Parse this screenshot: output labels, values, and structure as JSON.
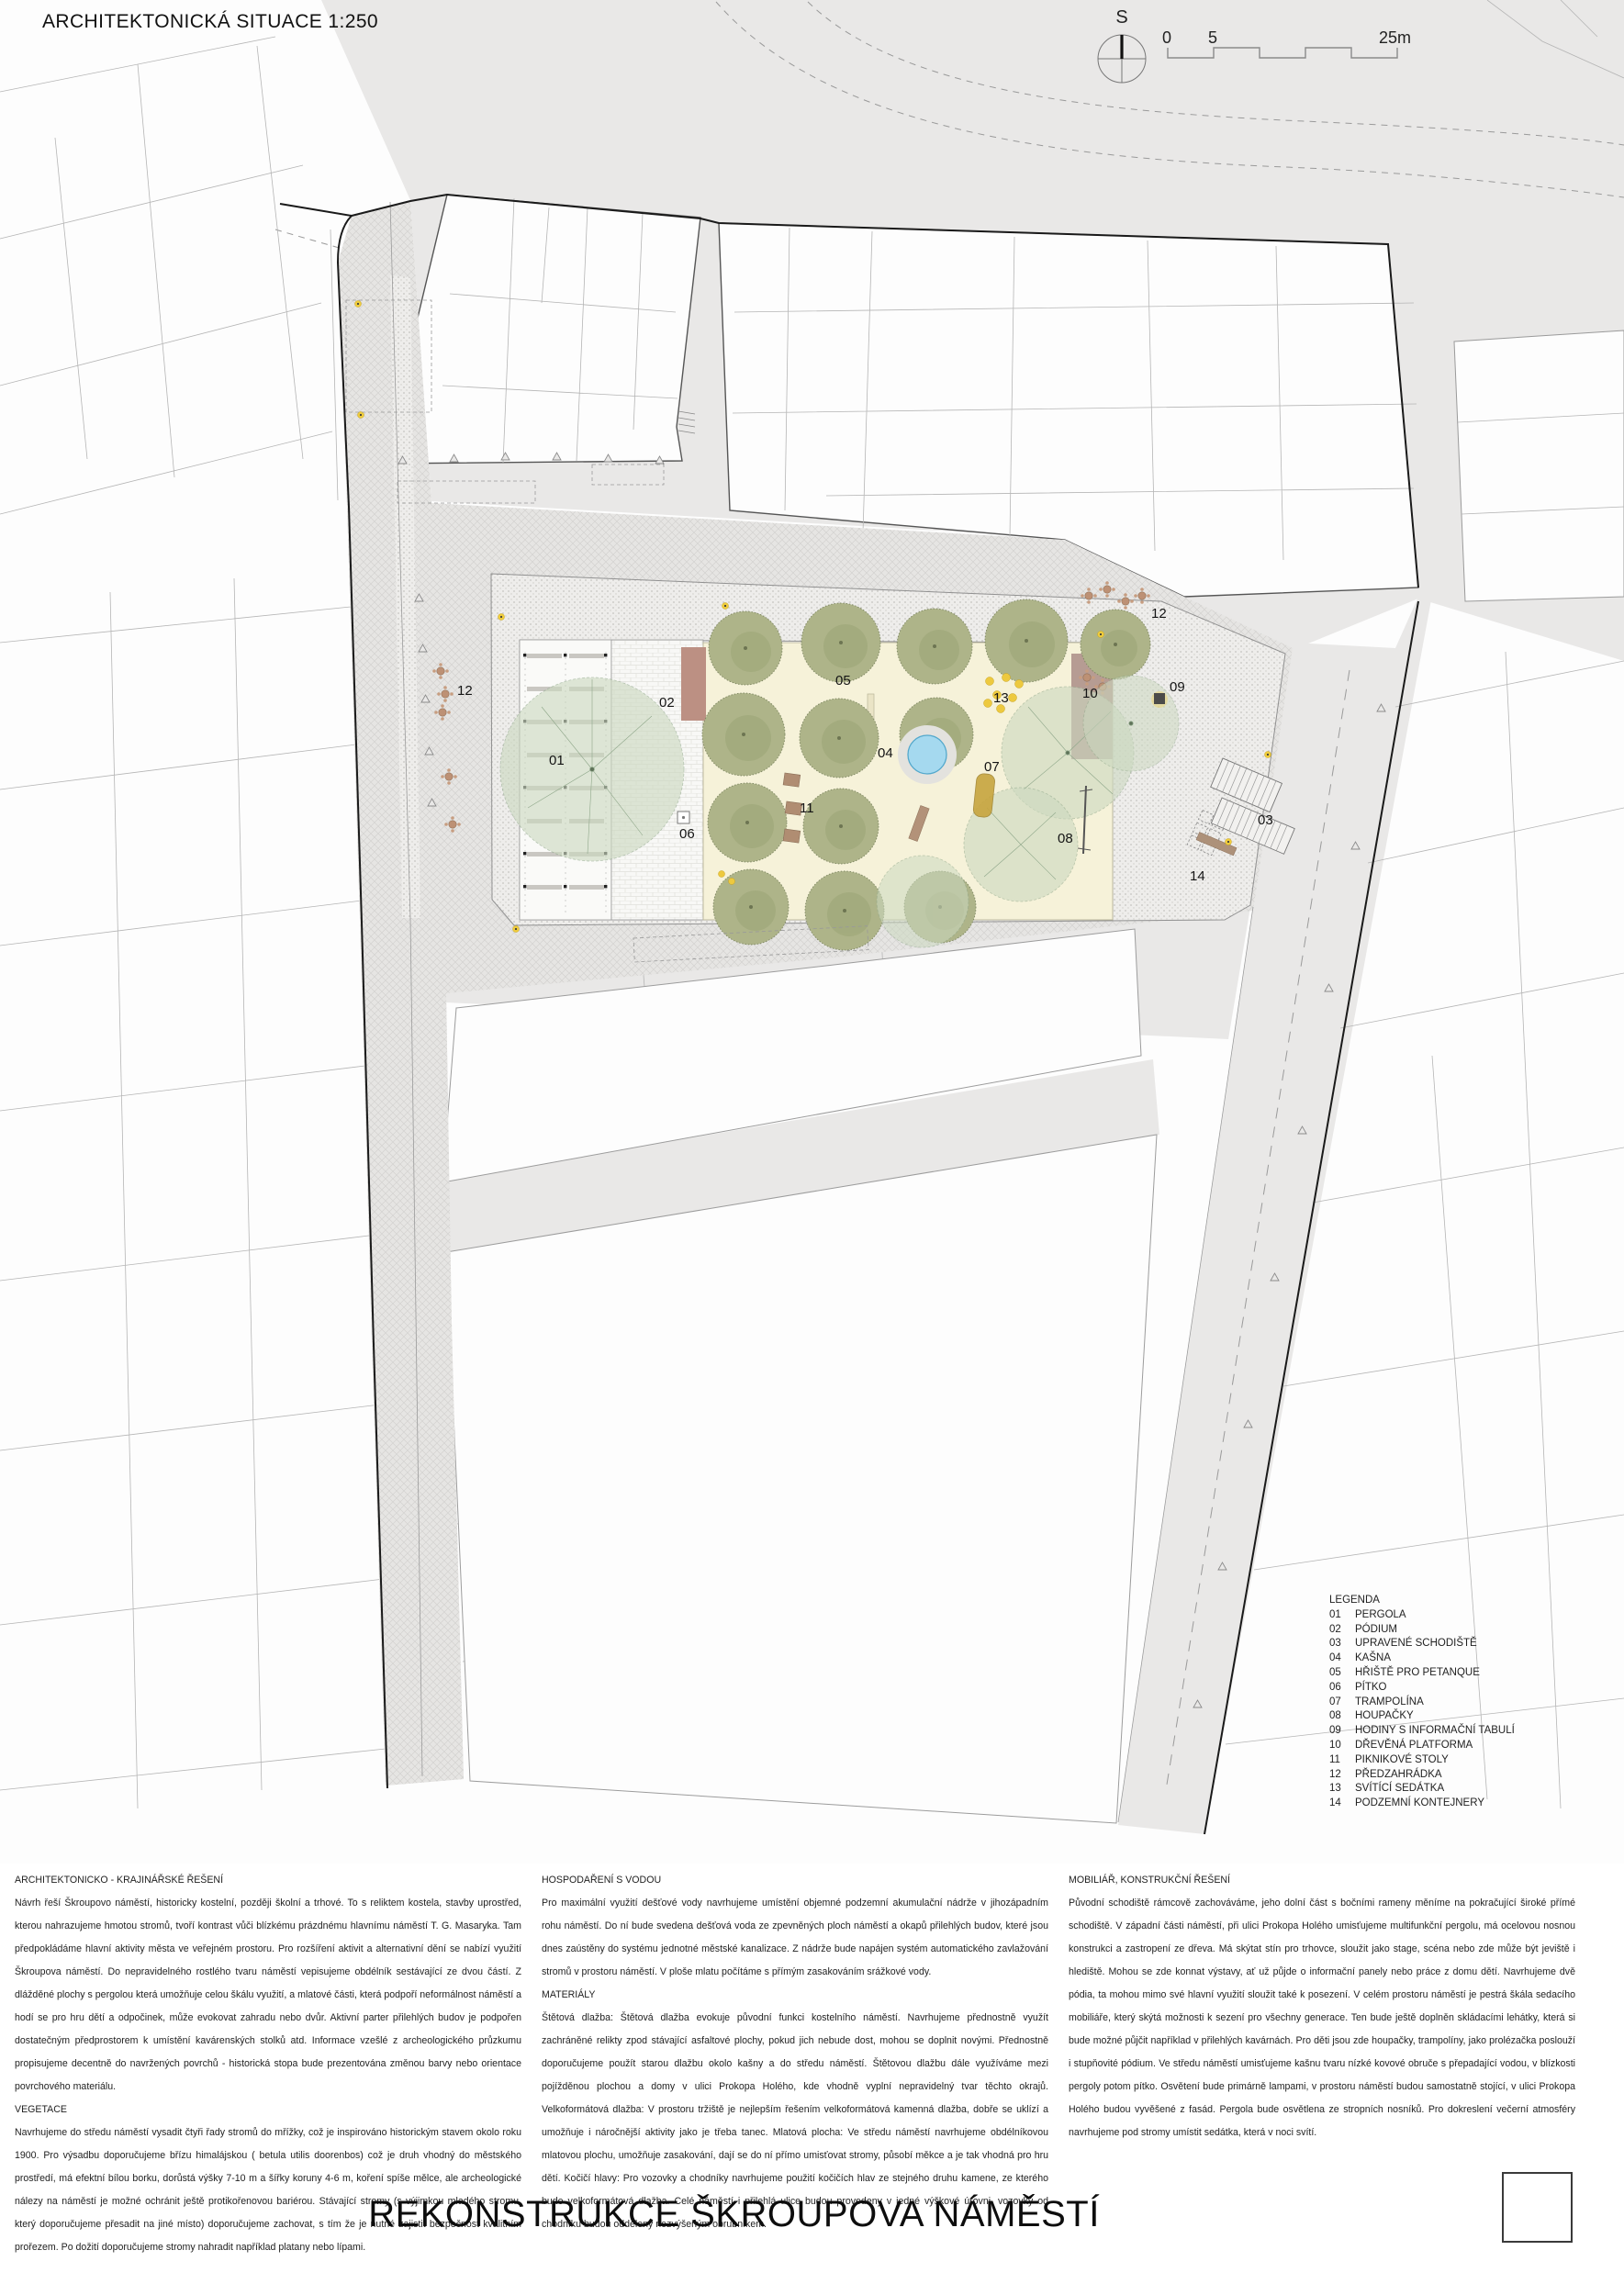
{
  "header": {
    "title": "ARCHITEKTONICKÁ SITUACE 1:250"
  },
  "north": {
    "label": "S"
  },
  "scalebar": {
    "zero": "0",
    "five": "5",
    "max": "25m"
  },
  "legend": {
    "title": "LEGENDA",
    "items": [
      {
        "num": "01",
        "label": "PERGOLA"
      },
      {
        "num": "02",
        "label": "PÓDIUM"
      },
      {
        "num": "03",
        "label": "UPRAVENÉ SCHODIŠTĚ"
      },
      {
        "num": "04",
        "label": "KAŠNA"
      },
      {
        "num": "05",
        "label": "HŘIŠTĚ PRO PETANQUE"
      },
      {
        "num": "06",
        "label": "PÍTKO"
      },
      {
        "num": "07",
        "label": "TRAMPOLÍNA"
      },
      {
        "num": "08",
        "label": "HOUPAČKY"
      },
      {
        "num": "09",
        "label": "HODINY S INFORMAČNÍ TABULÍ"
      },
      {
        "num": "10",
        "label": "DŘEVĚNÁ PLATFORMA"
      },
      {
        "num": "11",
        "label": "PIKNIKOVÉ STOLY"
      },
      {
        "num": "12",
        "label": "PŘEDZAHRÁDKA"
      },
      {
        "num": "13",
        "label": "SVÍTÍCÍ SEDÁTKA"
      },
      {
        "num": "14",
        "label": "PODZEMNÍ KONTEJNERY"
      }
    ]
  },
  "map": {
    "markers": [
      {
        "label": "01"
      },
      {
        "label": "02"
      },
      {
        "label": "03"
      },
      {
        "label": "04"
      },
      {
        "label": "05"
      },
      {
        "label": "06"
      },
      {
        "label": "07"
      },
      {
        "label": "08"
      },
      {
        "label": "09"
      },
      {
        "label": "10"
      },
      {
        "label": "11"
      },
      {
        "label": "12"
      },
      {
        "label": "12"
      },
      {
        "label": "13"
      },
      {
        "label": "14"
      }
    ]
  },
  "sections": {
    "col1": {
      "heading": "ARCHITEKTONICKO - KRAJINÁŘSKÉ ŘEŠENÍ",
      "body1": "Návrh řeší Škroupovo náměstí, historicky kostelní, později školní a trhové. To s reliktem kostela, stavby uprostřed, kterou nahrazujeme hmotou stromů, tvoří kontrast vůči blízkému prázdnému hlavnímu náměstí T. G. Masaryka. Tam předpokládáme hlavní aktivity města ve veřejném prostoru. Pro rozšíření aktivit a alternativní dění se nabízí využití Škroupova náměstí. Do nepravidelného rostlého tvaru náměstí vepisujeme obdélník sestávající ze dvou částí. Z dlážděné plochy s pergolou která umožňuje celou škálu využití, a mlatové části, která podpoří neformálnost náměstí a hodí se pro hru dětí a odpočinek, může evokovat zahradu nebo dvůr. Aktivní parter přilehlých budov je podpořen dostatečným předprostorem k umístění kavárenských stolků atd. Informace vzešlé z archeologického průzkumu propisujeme decentně do navržených povrchů - historická stopa bude prezentována změnou barvy nebo orientace povrchového materiálu.",
      "sub": "VEGETACE",
      "body2": "Navrhujeme do středu náměstí vysadit čtyři řady stromů do mřížky, což je inspirováno historickým stavem okolo roku 1900. Pro výsadbu doporučujeme břízu himalájskou ( betula utilis doorenbos) což je druh vhodný do městského prostředí, má efektní bílou borku, dorůstá výšky 7-10 m a šířky koruny 4-6 m, koření spíše mělce, ale archeologické nálezy na náměstí je možné ochránit ještě protikořenovou bariérou. Stávající stromy (s výjimkou mladého stromu, který doporučujeme přesadit na jiné místo) doporučujeme zachovat, s tím že je nutné zajistit bezpečnost kvalitním prořezem. Po dožití doporučujeme stromy nahradit například platany nebo lípami."
    },
    "col2": {
      "heading": "HOSPODAŘENÍ S VODOU",
      "body1": "Pro maximální využití dešťové vody navrhujeme umístění objemné podzemní akumulační nádrže v jihozápadním rohu náměstí. Do ní bude svedena dešťová voda ze zpevněných ploch náměstí a okapů přilehlých budov, které jsou dnes zaústěny do systému jednotné městské kanalizace. Z nádrže bude napájen systém automatického zavlažování stromů v prostoru náměstí. V ploše mlatu počítáme s přímým zasakováním srážkové vody.",
      "sub": "MATERIÁLY",
      "body2": "Štětová dlažba: Štětová dlažba evokuje původní funkci kostelního náměstí. Navrhujeme přednostně využít zachráněné relikty zpod stávající asfaltové plochy, pokud jich nebude dost, mohou se doplnit novými. Přednostně doporučujeme použít starou dlažbu okolo kašny a do středu náměstí. Štětovou dlažbu dále využíváme mezi pojížděnou plochou a domy v ulici Prokopa Holého, kde vhodně vyplní nepravidelný tvar těchto okrajů. Velkoformátová dlažba: V prostoru tržiště je nejlepším řešením velkoformátová kamenná dlažba, dobře se uklízí a umožňuje i náročnější aktivity jako je třeba tanec. Mlatová plocha: Ve středu náměstí navrhujeme obdélníkovou mlatovou plochu, umožňuje zasakování, dají se do ní přímo umisťovat stromy, působí měkce a je tak vhodná pro hru dětí. Kočičí hlavy: Pro vozovky a chodníky navrhujeme použití kočičích hlav ze stejného druhu kamene, ze kterého bude velkoformátová dlažba. Celé náměstí i přilehlá ulice budou provedeny v jedné výškové úrovni, vozovky od chodníku budou odděleny nezvýšeným obrubníkem."
    },
    "col3": {
      "heading": "MOBILIÁŘ, KONSTRUKČNÍ ŘEŠENÍ",
      "body1": "Původní schodiště rámcově zachováváme, jeho dolní část s bočními rameny měníme na pokračující široké přímé schodiště. V západní části náměstí, při ulici Prokopa Holého umisťujeme multifunkční pergolu, má ocelovou nosnou konstrukci a zastropení ze dřeva. Má skýtat stín pro trhovce, sloužit jako stage, scéna nebo zde může být jeviště i hlediště. Mohou se zde konnat výstavy, ať už půjde o informační panely nebo práce z domu dětí.  Navrhujeme dvě pódia, ta mohou mimo své hlavní využití sloužit také k posezení. V celém prostoru náměstí je pestrá škála sedacího mobiliáře, který skýtá možnosti k sezení pro všechny generace. Ten bude ještě doplněn skládacími lehátky, která si bude možné půjčit například v přilehlých kavárnách. Pro děti jsou zde houpačky, trampolíny, jako prolézačka poslouží i stupňovité pódium. Ve středu náměstí umisťujeme kašnu tvaru nízké kovové obruče s přepadající vodou, v blízkosti pergoly potom pítko. Osvětení bude primárně lampami, v prostoru náměstí budou samostatně stojící, v ulici Prokopa Holého budou vyvěšené z fasád. Pergola bude osvětlena ze stropních nosníků. Pro dokreslení večerní atmosféry navrhujeme pod stromy umístit sedátka, která v noci svítí."
    }
  },
  "footer": {
    "title": "REKONSTRUKCE ŠKROUPOVA NÁMĚSTÍ"
  },
  "colors": {
    "mlat": "#f6f2d9",
    "tree": "#aeb489",
    "water": "#a5d9ef",
    "wood_deck": "#b2978f",
    "podium": "#bc9083",
    "accent_yellow": "#f0cd3c"
  }
}
